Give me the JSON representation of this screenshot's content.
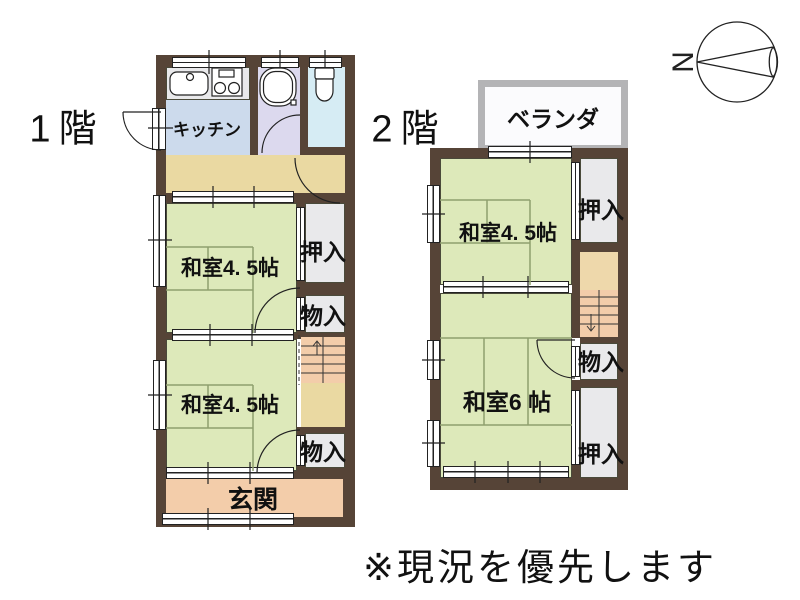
{
  "note": "※現況を優先します",
  "floor1": {
    "label": "1階",
    "kitchen": "キッチン",
    "washitsu_mid": "和室4. 5帖",
    "washitsu_low": "和室4. 5帖",
    "genkan": "玄関",
    "oshiire": "押入",
    "monoire_mid": "物入",
    "monoire_low": "物入"
  },
  "floor2": {
    "label": "2階",
    "veranda": "ベランダ",
    "washitsu_45": "和室4. 5帖",
    "washitsu_6": "和室6 帖",
    "oshiire_top": "押入",
    "monoire": "物入",
    "oshiire_bottom": "押入"
  },
  "compass": {
    "north": "N"
  },
  "colors": {
    "wall": "#564437",
    "tatami": "#dde9ba",
    "kitchen_floor": "#ccdaec",
    "bath_floor": "#dcd9ee",
    "toilet_floor": "#d6ecf4",
    "hallway": "#ead9a2",
    "entry_and_stairs": "#f3cdaa",
    "closet": "#e9e9eb",
    "veranda_border": "#b4b4b6"
  }
}
